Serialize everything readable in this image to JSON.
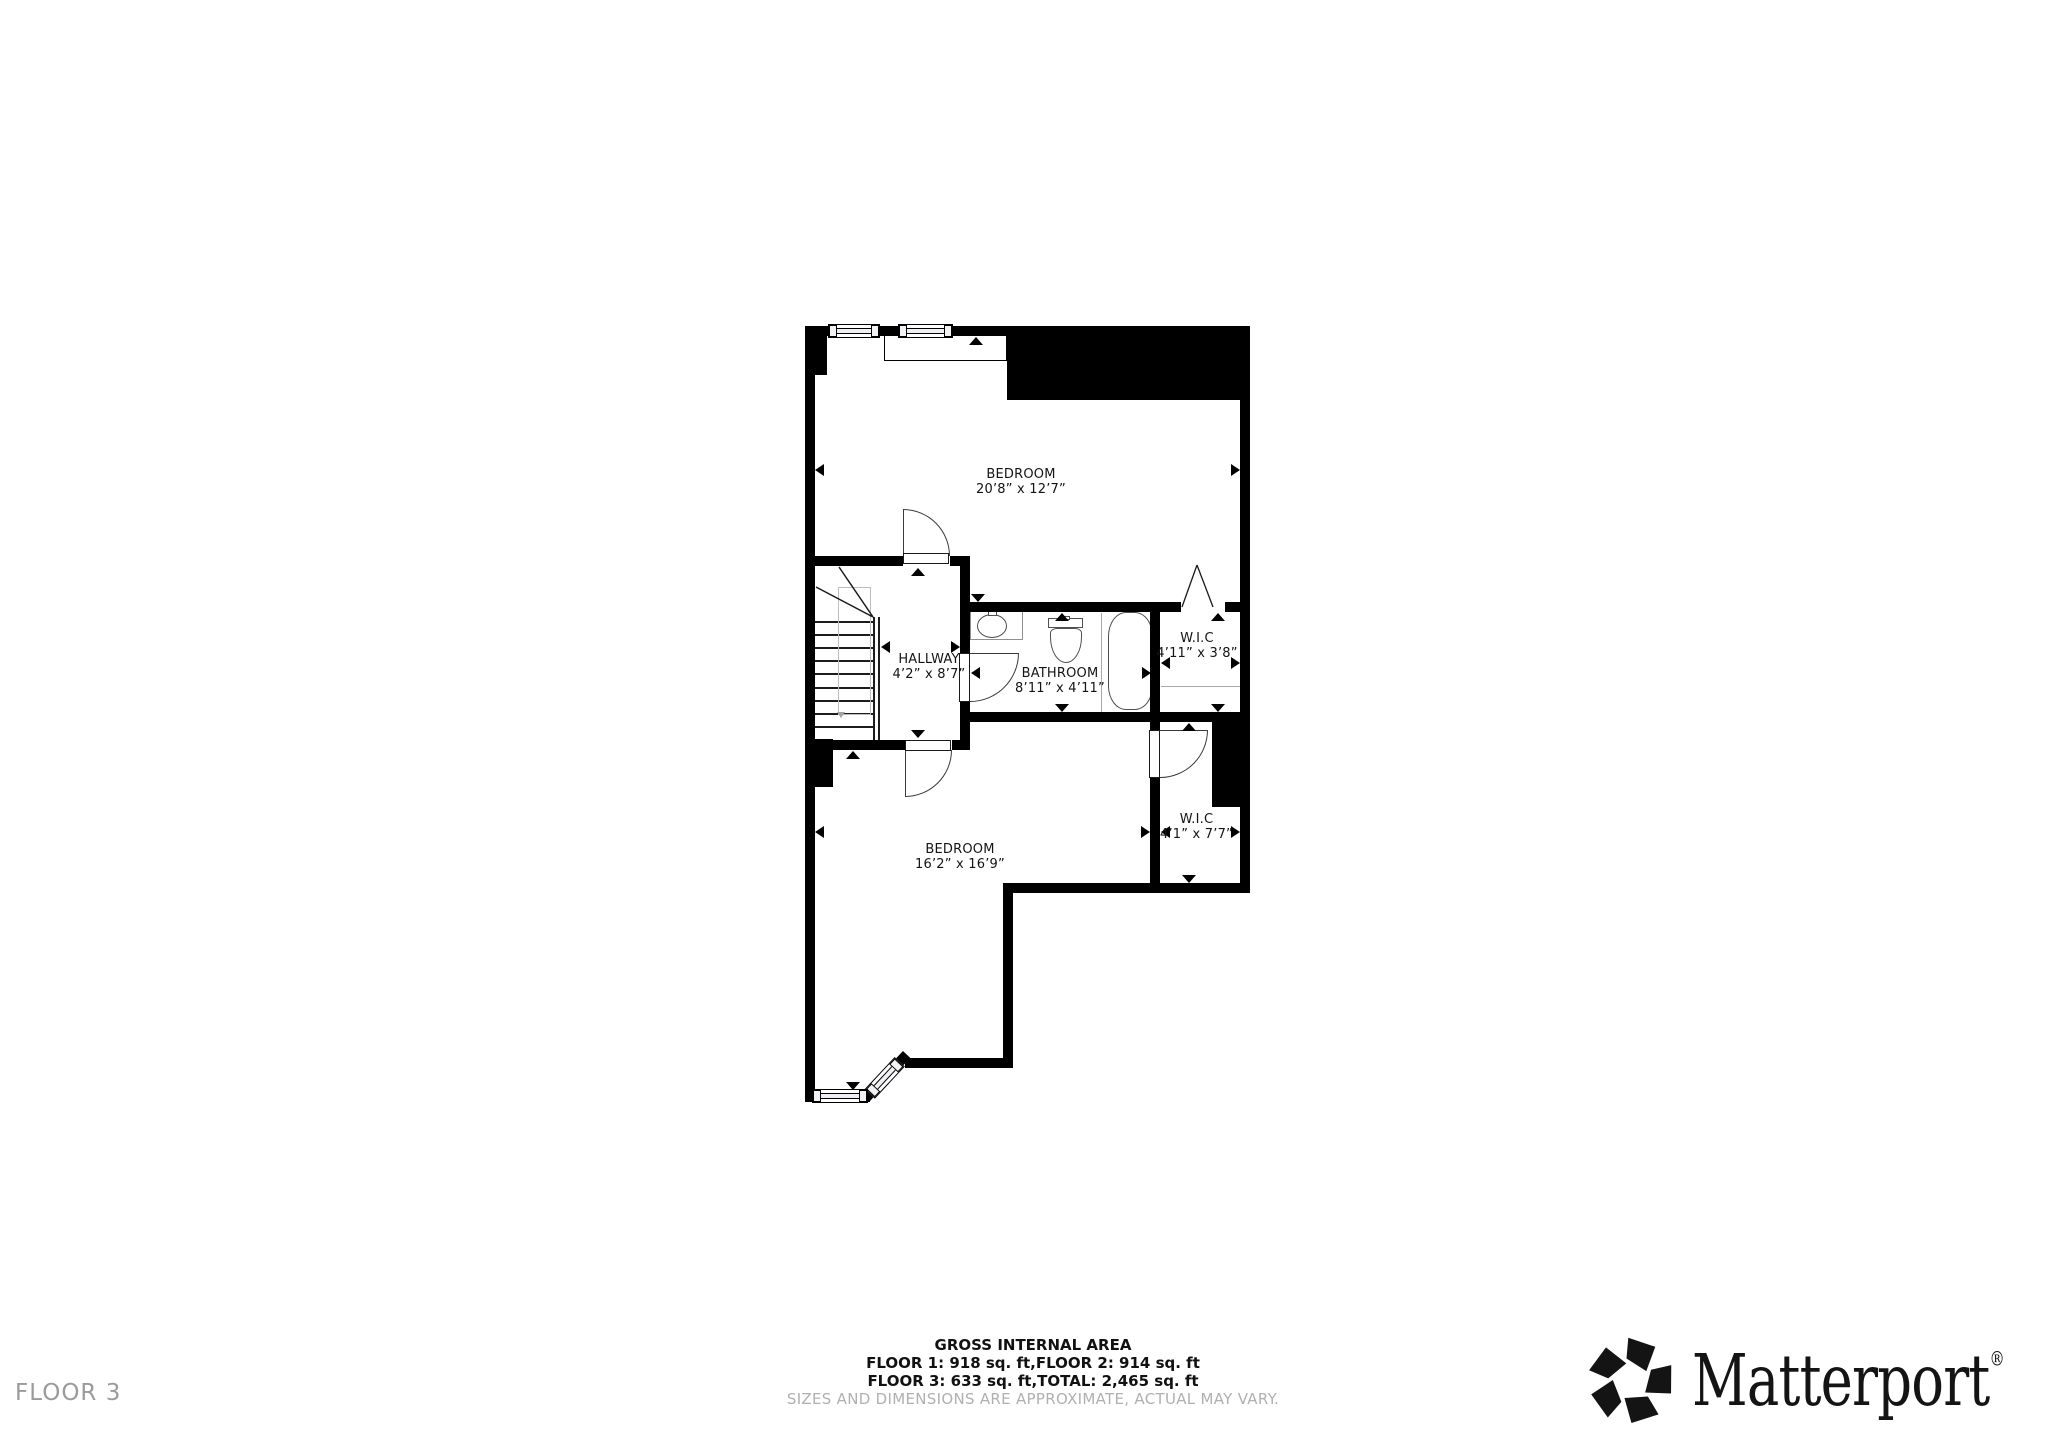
{
  "floor_tag": "FLOOR 3",
  "rooms": [
    {
      "name": "BEDROOM",
      "dims": "20’8” x 12’7”"
    },
    {
      "name": "HALLWAY",
      "dims": "4’2” x 8’7”"
    },
    {
      "name": "BATHROOM",
      "dims": "8’11” x 4’11”"
    },
    {
      "name": "W.I.C",
      "dims": "4’11” x 3’8”"
    },
    {
      "name": "BEDROOM",
      "dims": "16’2” x 16’9”"
    },
    {
      "name": "W.I.C",
      "dims": "4’1” x 7’7”"
    }
  ],
  "footer": {
    "title": "GROSS INTERNAL AREA",
    "line1": "FLOOR 1: 918 sq. ft,FLOOR 2: 914 sq. ft",
    "line2": "FLOOR 3: 633 sq. ft,TOTAL: 2,465 sq. ft",
    "disclaimer": "SIZES AND DIMENSIONS ARE APPROXIMATE, ACTUAL MAY VARY."
  },
  "branding": {
    "logo_text": "Matterport",
    "registered_mark": "®"
  },
  "colors": {
    "wall": "#000000",
    "fixture_stroke": "#4f4f4f",
    "muted_text": "#b0b0b0",
    "floor_tag_text": "#9b9b9b"
  }
}
